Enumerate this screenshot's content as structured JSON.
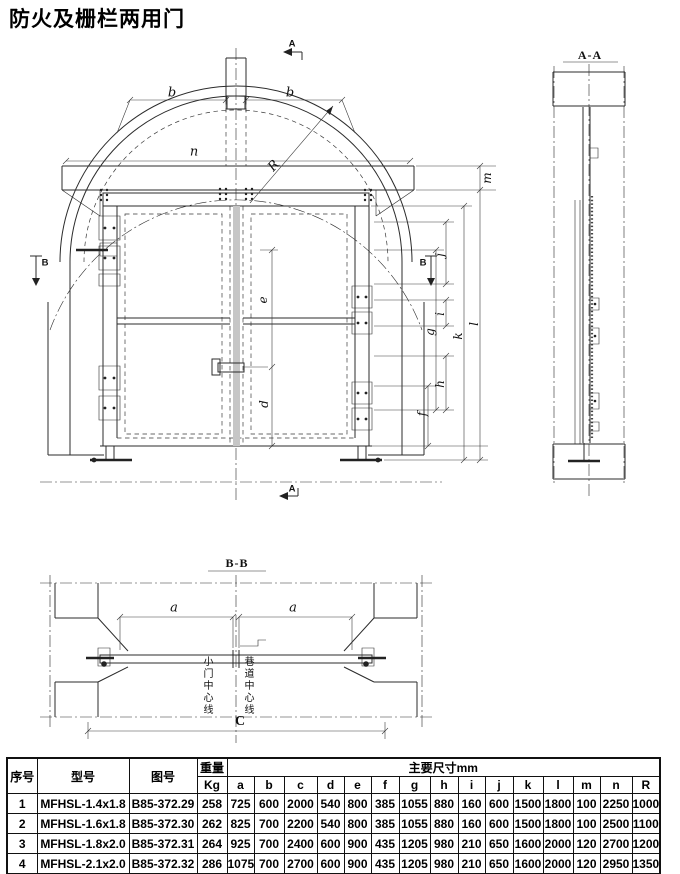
{
  "title": "防火及栅栏两用门",
  "front_view": {
    "section_marker_a": "A",
    "section_marker_b": "B",
    "dims": {
      "b": "b",
      "n": "n",
      "R": "R",
      "e": "e",
      "d": "d",
      "f": "f",
      "g": "g",
      "h": "h",
      "i": "i",
      "j": "j",
      "k": "k",
      "l": "l",
      "m": "m"
    }
  },
  "side_view": {
    "label": "A-A"
  },
  "plan_view": {
    "label": "B-B",
    "dim_a": "a",
    "dim_c": "C",
    "small_door_centerline": "小门中心线",
    "tunnel_centerline": "巷道中心线"
  },
  "table": {
    "headers": {
      "index": "序号",
      "model": "型号",
      "drawing_no": "图号",
      "weight": "重量",
      "weight_unit": "Kg",
      "main_dims": "主要尺寸mm",
      "dim_cols": [
        "a",
        "b",
        "c",
        "d",
        "e",
        "f",
        "g",
        "h",
        "i",
        "j",
        "k",
        "l",
        "m",
        "n",
        "R"
      ]
    },
    "rows": [
      {
        "index": "1",
        "model": "MFHSL-1.4x1.8",
        "drawing_no": "B85-372.29",
        "weight": "258",
        "dims": [
          "725",
          "600",
          "2000",
          "540",
          "800",
          "385",
          "1055",
          "880",
          "160",
          "600",
          "1500",
          "1800",
          "100",
          "2250",
          "1000"
        ]
      },
      {
        "index": "2",
        "model": "MFHSL-1.6x1.8",
        "drawing_no": "B85-372.30",
        "weight": "262",
        "dims": [
          "825",
          "700",
          "2200",
          "540",
          "800",
          "385",
          "1055",
          "880",
          "160",
          "600",
          "1500",
          "1800",
          "100",
          "2500",
          "1100"
        ]
      },
      {
        "index": "3",
        "model": "MFHSL-1.8x2.0",
        "drawing_no": "B85-372.31",
        "weight": "264",
        "dims": [
          "925",
          "700",
          "2400",
          "600",
          "900",
          "435",
          "1205",
          "980",
          "210",
          "650",
          "1600",
          "2000",
          "120",
          "2700",
          "1200"
        ]
      },
      {
        "index": "4",
        "model": "MFHSL-2.1x2.0",
        "drawing_no": "B85-372.32",
        "weight": "286",
        "dims": [
          "1075",
          "700",
          "2700",
          "600",
          "900",
          "435",
          "1205",
          "980",
          "210",
          "650",
          "1600",
          "2000",
          "120",
          "2950",
          "1350"
        ]
      }
    ]
  }
}
